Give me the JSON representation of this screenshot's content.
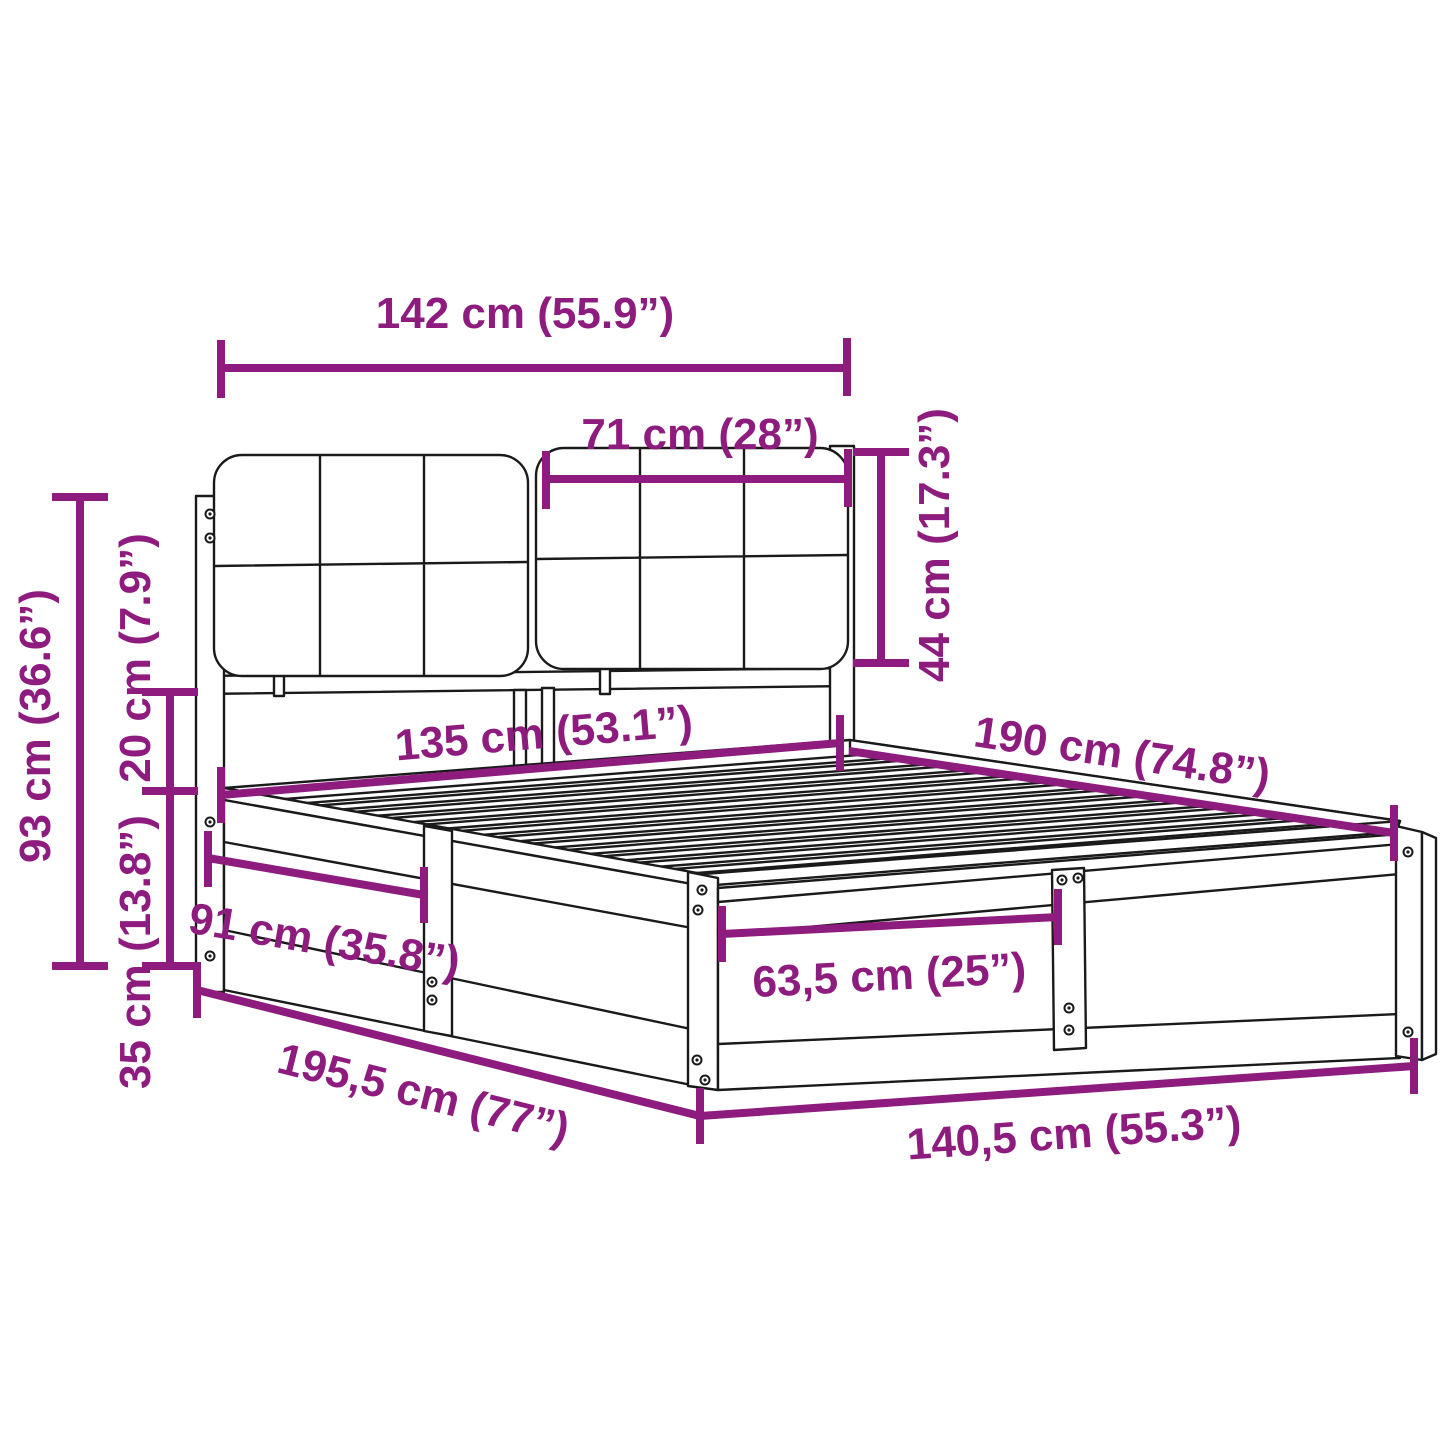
{
  "colors": {
    "dimension_color": "#8E1B7E",
    "line_color": "#1a1a1a",
    "background": "#ffffff"
  },
  "diagram": {
    "subject": "bed-frame-with-upholstered-headboard",
    "dimensions": [
      {
        "id": "total_width_top",
        "label": "142 cm (55.9”)"
      },
      {
        "id": "headboard_cushion_width",
        "label": "71 cm (28”)"
      },
      {
        "id": "headboard_cushion_height",
        "label": "44 cm (17.3”)"
      },
      {
        "id": "headboard_total_height",
        "label": "93 cm (36.6”)"
      },
      {
        "id": "clearance_height",
        "label": "20 cm (7.9”)"
      },
      {
        "id": "frame_side_height",
        "label": "35 cm (13.8”)"
      },
      {
        "id": "platform_width",
        "label": "135 cm (53.1”)"
      },
      {
        "id": "platform_length",
        "label": "190 cm (74.8”)"
      },
      {
        "id": "side_panel_section_width",
        "label": "91 cm (35.8”)"
      },
      {
        "id": "foot_panel_section_width",
        "label": "63,5 cm (25”)"
      },
      {
        "id": "total_length",
        "label": "195,5 cm (77”)"
      },
      {
        "id": "total_width_bottom",
        "label": "140,5 cm (55.3”)"
      }
    ]
  }
}
